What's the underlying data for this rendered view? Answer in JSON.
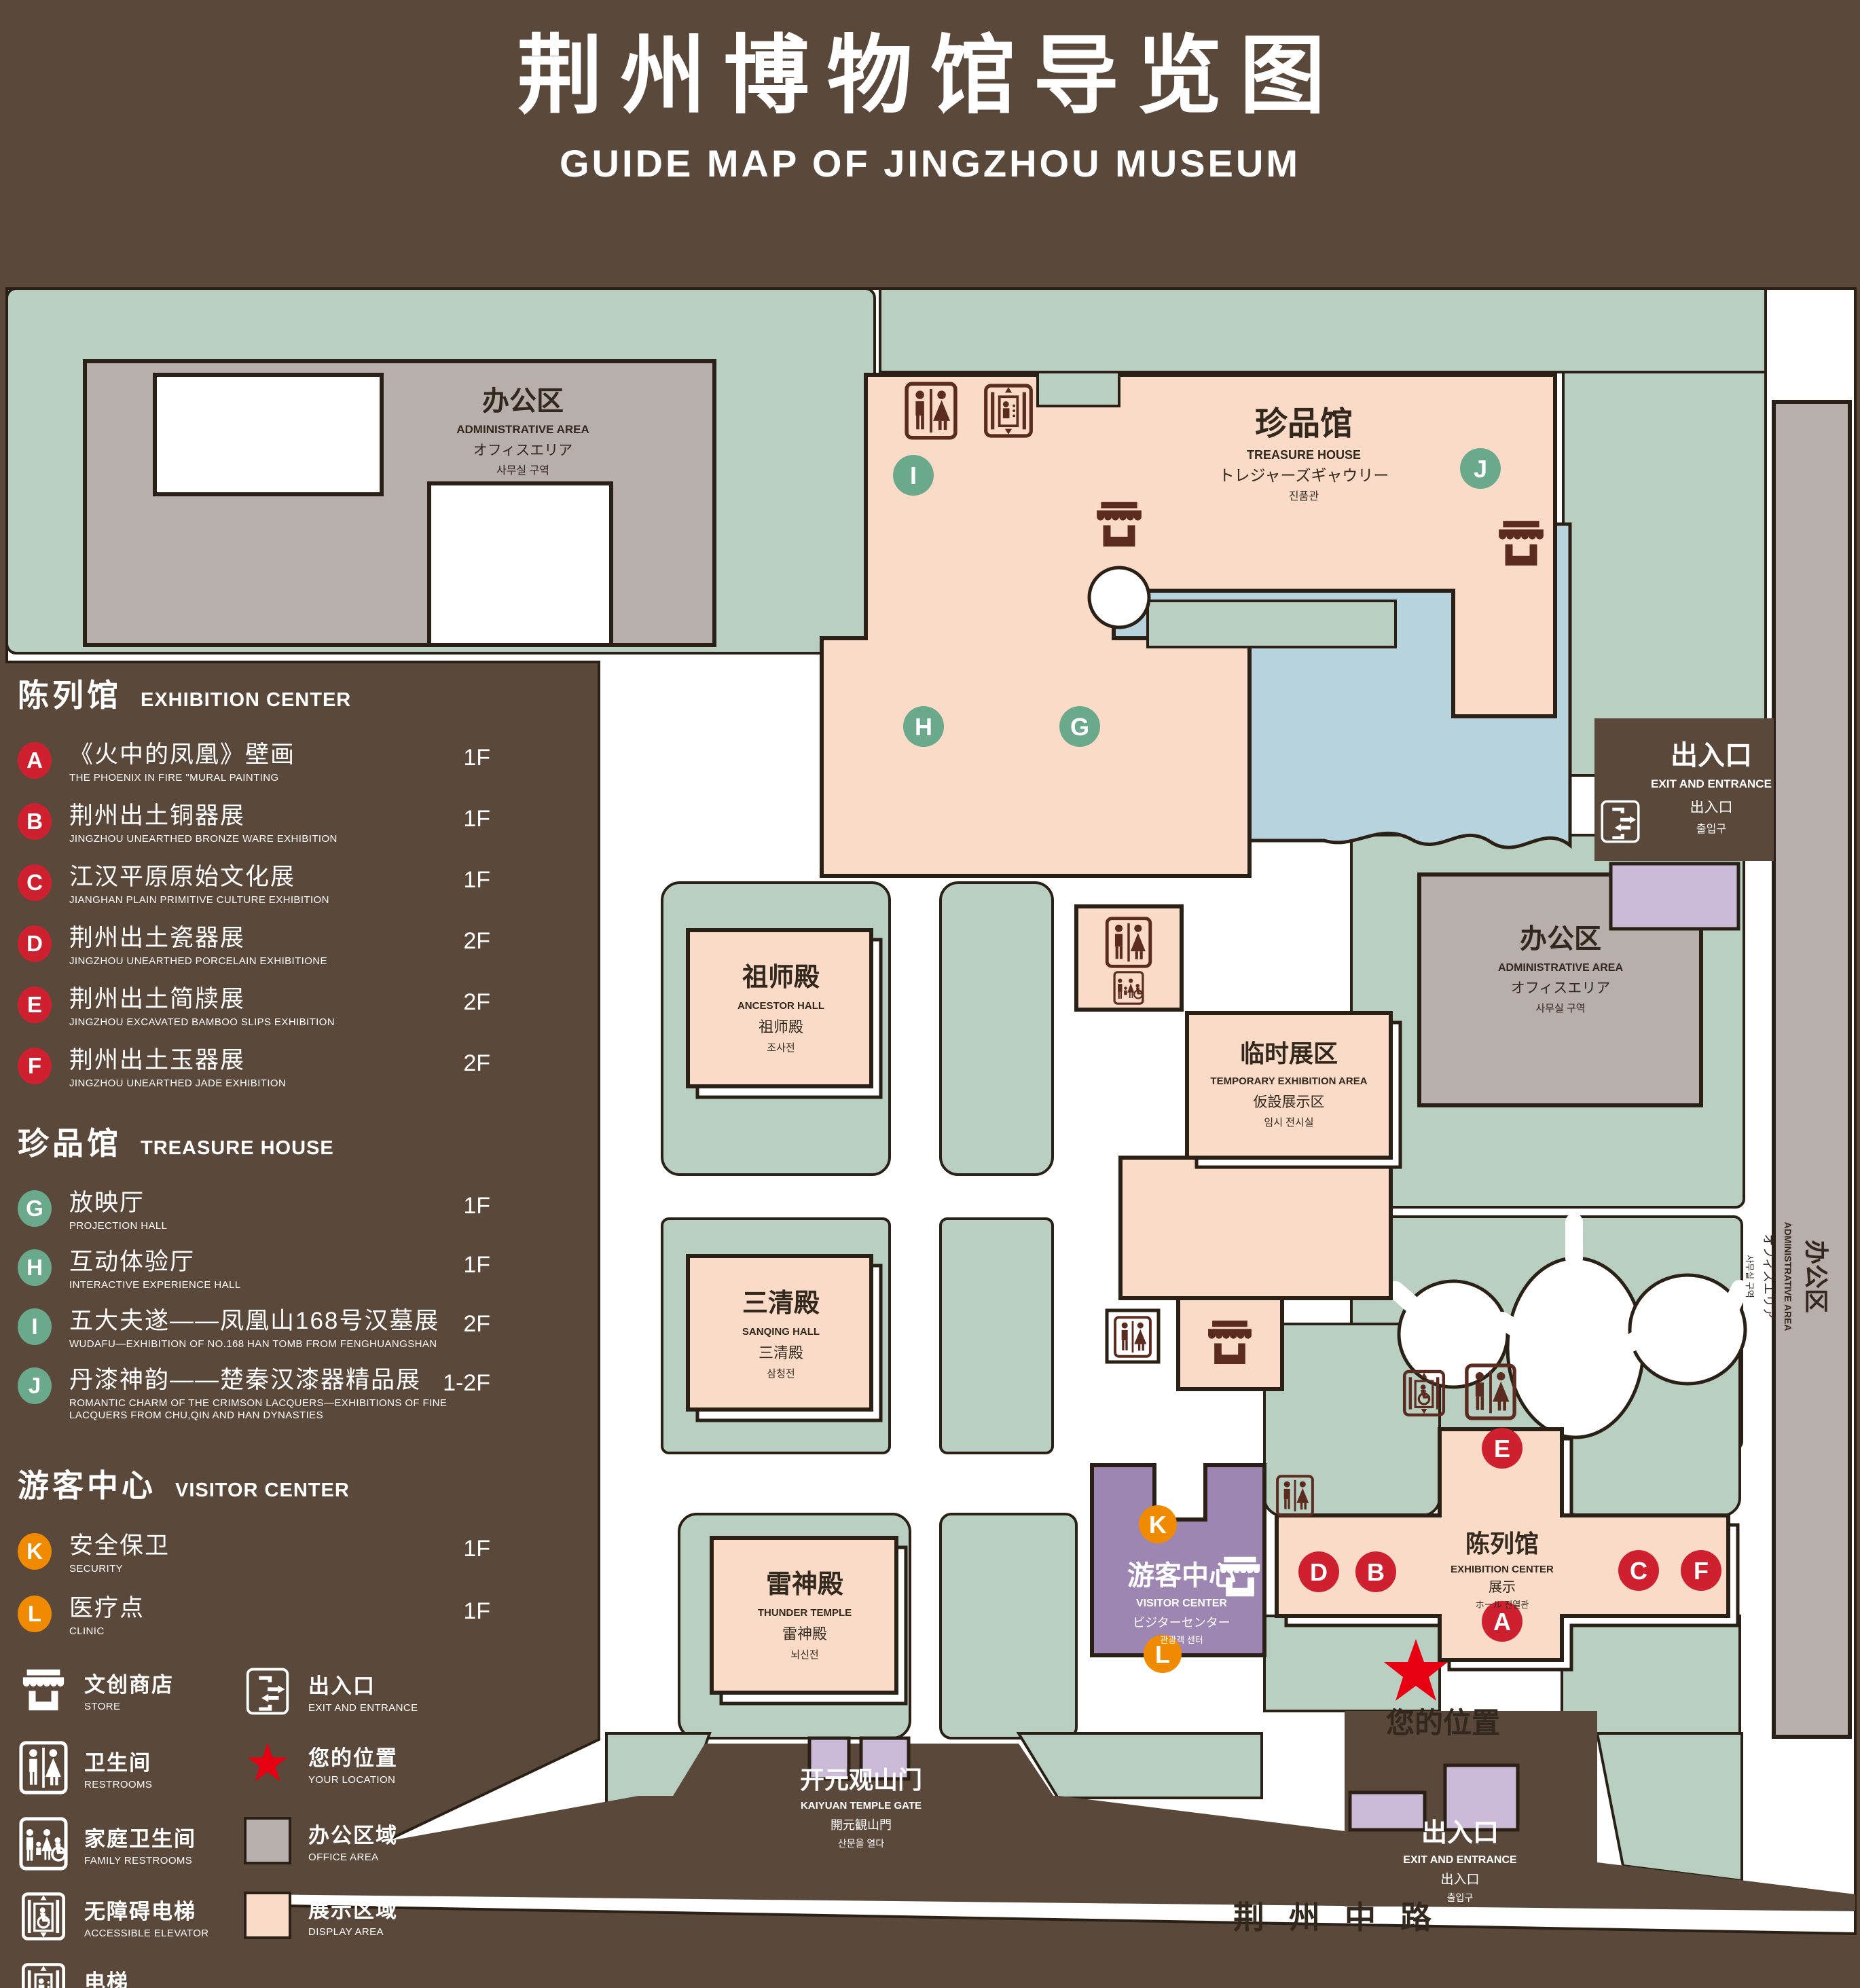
{
  "title": {
    "zh": "荆州博物馆导览图",
    "en": "GUIDE MAP OF JINGZHOU MUSEUM"
  },
  "colors": {
    "background": "#5a483b",
    "area_green": "#b9cfc1",
    "display_pink": "#f9dbc7",
    "office_gray": "#b6afab",
    "lake_blue": "#b7d3de",
    "visitor_purple": "#9d87b2",
    "gate_purple": "#cbbad8",
    "marker_red": "#cf202f",
    "marker_green": "#6aa98c",
    "marker_orange": "#f08a00",
    "location_red": "#e60012",
    "outline": "#2b2015",
    "icon_brown": "#5a2b1e"
  },
  "legend": {
    "sections": [
      {
        "zh": "陈列馆",
        "en": "EXHIBITION CENTER",
        "items": [
          {
            "letter": "A",
            "zh": "《火中的凤凰》壁画",
            "en": "THE PHOENIX IN FIRE \"MURAL PAINTING",
            "floor": "1F"
          },
          {
            "letter": "B",
            "zh": "荆州出土铜器展",
            "en": "JINGZHOU UNEARTHED BRONZE WARE EXHIBITION",
            "floor": "1F"
          },
          {
            "letter": "C",
            "zh": "江汉平原原始文化展",
            "en": "JIANGHAN PLAIN PRIMITIVE CULTURE EXHIBITION",
            "floor": "1F"
          },
          {
            "letter": "D",
            "zh": "荆州出土瓷器展",
            "en": "JINGZHOU UNEARTHED PORCELAIN EXHIBITIONE",
            "floor": "2F"
          },
          {
            "letter": "E",
            "zh": "荆州出土简牍展",
            "en": "JINGZHOU EXCAVATED BAMBOO SLIPS EXHIBITION",
            "floor": "2F"
          },
          {
            "letter": "F",
            "zh": "荆州出土玉器展",
            "en": "JINGZHOU UNEARTHED JADE EXHIBITION",
            "floor": "2F"
          }
        ]
      },
      {
        "zh": "珍品馆",
        "en": "TREASURE HOUSE",
        "items": [
          {
            "letter": "G",
            "zh": "放映厅",
            "en": "PROJECTION HALL",
            "floor": "1F"
          },
          {
            "letter": "H",
            "zh": "互动体验厅",
            "en": "INTERACTIVE EXPERIENCE HALL",
            "floor": "1F"
          },
          {
            "letter": "I",
            "zh": "五大夫遂——凤凰山168号汉墓展",
            "en": "WUDAFU—EXHIBITION OF NO.168 HAN TOMB FROM FENGHUANGSHAN",
            "floor": "2F"
          },
          {
            "letter": "J",
            "zh": "丹漆神韵——楚秦汉漆器精品展",
            "en": "ROMANTIC CHARM OF THE CRIMSON LACQUERS—EXHIBITIONS OF FINE LACQUERS FROM CHU,QIN AND HAN DYNASTIES",
            "floor": "1-2F"
          }
        ]
      },
      {
        "zh": "游客中心",
        "en": "VISITOR CENTER",
        "items": [
          {
            "letter": "K",
            "zh": "安全保卫",
            "en": "SECURITY",
            "floor": "1F"
          },
          {
            "letter": "L",
            "zh": "医疗点",
            "en": "CLINIC",
            "floor": "1F"
          }
        ]
      }
    ],
    "symbols": [
      {
        "icon": "store-icon",
        "zh": "文创商店",
        "en": "STORE"
      },
      {
        "icon": "exit-icon",
        "zh": "出入口",
        "en": "EXIT AND ENTRANCE"
      },
      {
        "icon": "restroom-icon",
        "zh": "卫生间",
        "en": "RESTROOMS"
      },
      {
        "icon": "location-star-icon",
        "zh": "您的位置",
        "en": "YOUR LOCATION"
      },
      {
        "icon": "family-restroom-icon",
        "zh": "家庭卫生间",
        "en": "FAMILY RESTROOMS"
      },
      {
        "icon": "office-area-swatch",
        "zh": "办公区域",
        "en": "OFFICE AREA"
      },
      {
        "icon": "accessible-elevator-icon",
        "zh": "无障碍电梯",
        "en": "ACCESSIBLE ELEVATOR"
      },
      {
        "icon": "display-area-swatch",
        "zh": "展示区域",
        "en": "DISPLAY AREA"
      },
      {
        "icon": "elevator-icon",
        "zh": "电梯",
        "en": "Elevator"
      }
    ]
  },
  "map": {
    "admin_area": [
      "办公区",
      "ADMINISTRATIVE AREA",
      "オフィスエリア",
      "사무실 구역"
    ],
    "treasure_house": [
      "珍品馆",
      "TREASURE HOUSE",
      "トレジャーズギャウリー",
      "진품관"
    ],
    "ancestor_hall": [
      "祖师殿",
      "ANCESTOR HALL",
      "祖师殿",
      "조사전"
    ],
    "sanqing_hall": [
      "三清殿",
      "SANQING HALL",
      "三清殿",
      "삼청전"
    ],
    "thunder_temple": [
      "雷神殿",
      "THUNDER TEMPLE",
      "雷神殿",
      "뇌신전"
    ],
    "temporary_area": [
      "临时展区",
      "TEMPORARY EXHIBITION AREA",
      "仮設展示区",
      "임시 전시실"
    ],
    "visitor_center": [
      "游客中心",
      "VISITOR CENTER",
      "ビジターセンター",
      "관광객 센터"
    ],
    "exhibition_center": [
      "陈列馆",
      "EXHIBITION CENTER",
      "展示",
      "ホール 진열관"
    ],
    "exit": [
      "出入口",
      "EXIT AND ENTRANCE",
      "出入口",
      "출입구"
    ],
    "gate": [
      "开元观山门",
      "KAIYUAN TEMPLE GATE",
      "開元観山門",
      "산문을 열다"
    ],
    "road": "荆州中路",
    "your_location": "您的位置",
    "markers": {
      "a": "A",
      "b": "B",
      "c": "C",
      "d": "D",
      "e": "E",
      "f": "F",
      "g": "G",
      "h": "H",
      "i": "I",
      "j": "J",
      "k": "K",
      "l": "L"
    }
  }
}
